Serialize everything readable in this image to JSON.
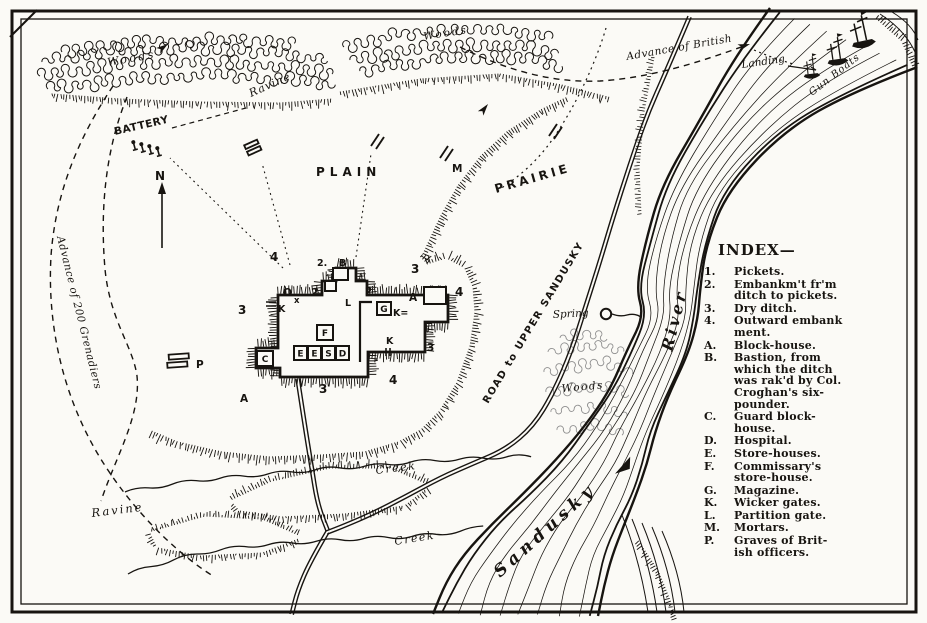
{
  "colors": {
    "ink": "#171410",
    "paper": "#fbfaf6",
    "faint_woods": "#8f8f8f"
  },
  "map_labels": {
    "woods_top_left": "Woods",
    "woods_top_center": "Woods",
    "woods_by_river": "Woods",
    "ravine_upper": "Ravine",
    "ravine_lower": "Ravine",
    "battery": "BATTERY",
    "plain": "PLAIN",
    "prairie": "PRAIRIE",
    "advance_of_british": "Advance of British",
    "landing": "Landing",
    "gun_boats": "Gun Boats",
    "road_to_upper_sandusky": "ROAD to UPPER SANDUSKY",
    "river_word": "River",
    "sandusky_word": "Sandusky",
    "spring": "Spring",
    "creek_upper": "Creek",
    "creek_lower": "Creek",
    "advance_of_200_grenadiers": "Advance of 200 Grenadiers"
  },
  "fort": {
    "markers": [
      {
        "t": "4",
        "x": 270,
        "y": 261,
        "s": 12
      },
      {
        "t": "2.",
        "x": 317,
        "y": 266,
        "s": 9.5
      },
      {
        "t": "B",
        "x": 339,
        "y": 266,
        "s": 9.5
      },
      {
        "t": "3",
        "x": 411,
        "y": 273,
        "s": 12
      },
      {
        "t": "A",
        "x": 409,
        "y": 301,
        "s": 10.5
      },
      {
        "t": "4",
        "x": 455,
        "y": 296,
        "s": 12
      },
      {
        "t": "3",
        "x": 427,
        "y": 351,
        "s": 10.5
      },
      {
        "t": "4",
        "x": 389,
        "y": 384,
        "s": 12
      },
      {
        "t": "3",
        "x": 319,
        "y": 393,
        "s": 12
      },
      {
        "t": "A",
        "x": 240,
        "y": 402,
        "s": 10.5
      },
      {
        "t": "3",
        "x": 238,
        "y": 314,
        "s": 12
      },
      {
        "t": "O",
        "x": 283,
        "y": 296,
        "s": 10.5
      },
      {
        "t": "x",
        "x": 294,
        "y": 303,
        "s": 8.5
      },
      {
        "t": "K",
        "x": 278,
        "y": 312,
        "s": 9.5
      },
      {
        "t": "2",
        "x": 311,
        "y": 296,
        "s": 10.5
      },
      {
        "t": "2",
        "x": 365,
        "y": 295,
        "s": 10.5
      },
      {
        "t": "L",
        "x": 345,
        "y": 306,
        "s": 9.5
      },
      {
        "t": "K=",
        "x": 393,
        "y": 316,
        "s": 9.5
      },
      {
        "t": "K",
        "x": 386,
        "y": 344,
        "s": 9.5
      },
      {
        "t": "N",
        "x": 155,
        "y": 180,
        "s": 12
      },
      {
        "t": "M",
        "x": 452,
        "y": 172,
        "s": 10.5
      },
      {
        "t": "P",
        "x": 196,
        "y": 368,
        "s": 10.5
      }
    ],
    "buildings": [
      {
        "t": "",
        "x": 424,
        "y": 287,
        "w": 22,
        "h": 17
      },
      {
        "t": "G",
        "x": 377,
        "y": 302,
        "w": 14,
        "h": 13
      },
      {
        "t": "F",
        "x": 317,
        "y": 325,
        "w": 16,
        "h": 15
      },
      {
        "t": "C",
        "x": 257,
        "y": 351,
        "w": 16,
        "h": 15
      },
      {
        "t": "E",
        "x": 294,
        "y": 346,
        "w": 13,
        "h": 14
      },
      {
        "t": "E",
        "x": 308,
        "y": 346,
        "w": 13,
        "h": 14
      },
      {
        "t": "S",
        "x": 322,
        "y": 346,
        "w": 13,
        "h": 14
      },
      {
        "t": "D",
        "x": 336,
        "y": 346,
        "w": 13,
        "h": 14
      },
      {
        "t": "",
        "x": 333,
        "y": 268,
        "w": 15,
        "h": 12
      },
      {
        "t": "",
        "x": 325,
        "y": 281,
        "w": 11,
        "h": 10
      }
    ]
  },
  "index": {
    "title": "INDEX—",
    "items": [
      {
        "key": "1.",
        "lines": [
          "Pickets."
        ]
      },
      {
        "key": "2.",
        "lines": [
          "Embankm't fr'm",
          "ditch to pickets."
        ]
      },
      {
        "key": "3.",
        "lines": [
          "Dry ditch."
        ]
      },
      {
        "key": "4.",
        "lines": [
          "Outward embank",
          "ment."
        ]
      },
      {
        "key": "A.",
        "lines": [
          "Block-house."
        ]
      },
      {
        "key": "B.",
        "lines": [
          "Bastion, from",
          "which the ditch",
          "was rak'd by Col.",
          "Croghan's six-",
          "pounder."
        ]
      },
      {
        "key": "C.",
        "lines": [
          "Guard block-",
          "house."
        ]
      },
      {
        "key": "D.",
        "lines": [
          "Hospital."
        ]
      },
      {
        "key": "E.",
        "lines": [
          "Store-houses."
        ]
      },
      {
        "key": "F.",
        "lines": [
          "Commissary's",
          "store-house."
        ]
      },
      {
        "key": "G.",
        "lines": [
          "Magazine."
        ]
      },
      {
        "key": "K.",
        "lines": [
          "Wicker gates."
        ]
      },
      {
        "key": "L.",
        "lines": [
          "Partition gate."
        ]
      },
      {
        "key": "M.",
        "lines": [
          "Mortars."
        ]
      },
      {
        "key": "P.",
        "lines": [
          "Graves of Brit-",
          "ish officers."
        ]
      }
    ]
  }
}
